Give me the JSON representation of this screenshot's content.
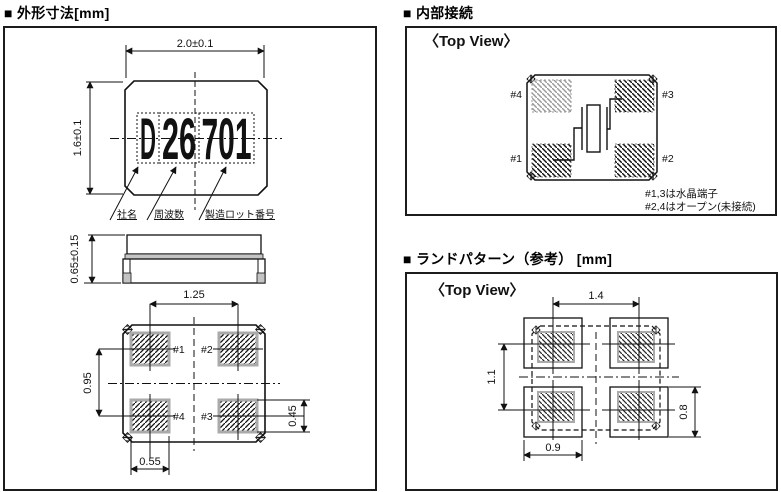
{
  "page": {
    "background": "#ffffff",
    "line_color": "#1a1a1a",
    "pad_border_color": "#aaaaaa",
    "light_hatch_color": "#9a9a9a"
  },
  "outline_panel": {
    "title": "■ 外形寸法[mm]",
    "marking_parts": [
      "D",
      "26",
      "701"
    ],
    "callouts": {
      "company": "社名",
      "frequency": "周波数",
      "lot": "製造ロット番号"
    },
    "dims": {
      "body_width": "2.0±0.1",
      "body_height": "1.6±0.1",
      "thickness": "0.65±0.15",
      "pad_pitch_x": "1.25",
      "pad_pitch_y": "0.95",
      "pad_height": "0.45",
      "pad_width": "0.55"
    },
    "pad_labels": {
      "p1": "#1",
      "p2": "#2",
      "p3": "#3",
      "p4": "#4"
    }
  },
  "internal_panel": {
    "title": "■ 内部接続",
    "view_label": "〈Top View〉",
    "pad_labels": {
      "p1": "#1",
      "p2": "#2",
      "p3": "#3",
      "p4": "#4"
    },
    "notes": [
      "#1,3は水晶端子",
      "#2,4はオープン(未接続)"
    ]
  },
  "land_panel": {
    "title": "■ ランドパターン（参考） [mm]",
    "view_label": "〈Top View〉",
    "dims": {
      "pitch_x": "1.4",
      "pitch_y": "1.1",
      "land_width": "0.9",
      "land_height": "0.8"
    }
  }
}
